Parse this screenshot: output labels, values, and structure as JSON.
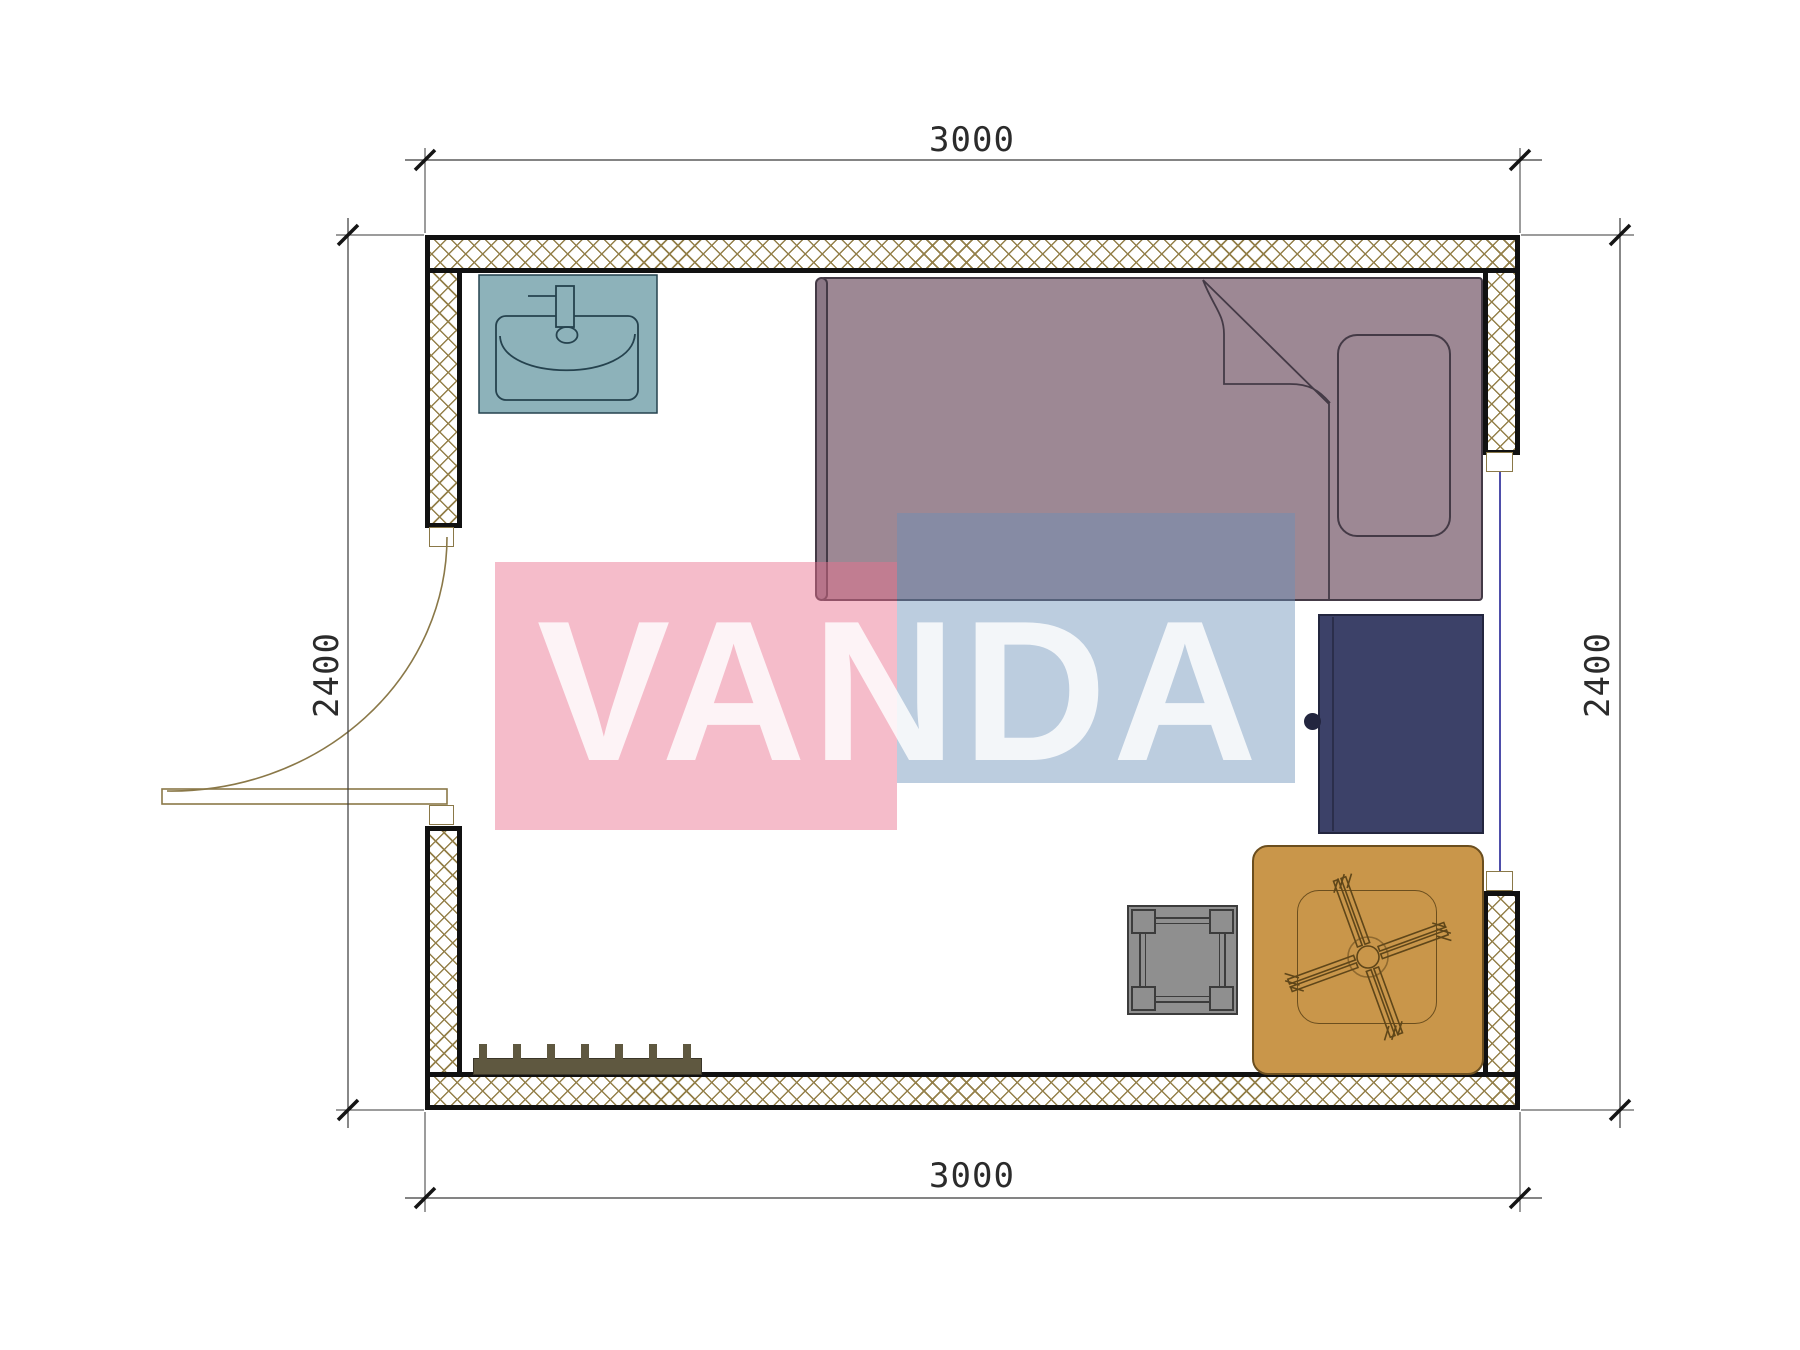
{
  "title": "Room floor plan",
  "watermark": {
    "text": "VANDA"
  },
  "dimensions": {
    "top": "3000",
    "bottom": "3000",
    "left": "2400",
    "right": "2400"
  },
  "furniture": [
    "sink",
    "single-bed",
    "pillow",
    "wardrobe",
    "table-with-rotor",
    "stool",
    "radiator",
    "door",
    "window"
  ],
  "colors": {
    "hatch": "#94804a",
    "wall_line": "#111111",
    "dim": "#3a3a3a",
    "dim_text": "#2b2b2b",
    "sink": "#8db2ba",
    "sink_line": "#25424e",
    "bed": "#9d8894",
    "bed_edge": "#8b7886",
    "bed_line": "#443a46",
    "wardrobe": "#3c4168",
    "wardrobe_line": "#23263f",
    "table": "#c9964a",
    "table_line": "#6b4e1e",
    "stool": "#8f8f8f",
    "stool_line": "#3c3c3c",
    "radiator": "#5f5840",
    "door_line": "#8a7848",
    "glazing": "#3a3aa0",
    "pink": "rgba(234,112,142,0.47)",
    "blue": "rgba(106,144,184,0.45)",
    "wm_text": "rgba(255,255,255,0.82)"
  }
}
